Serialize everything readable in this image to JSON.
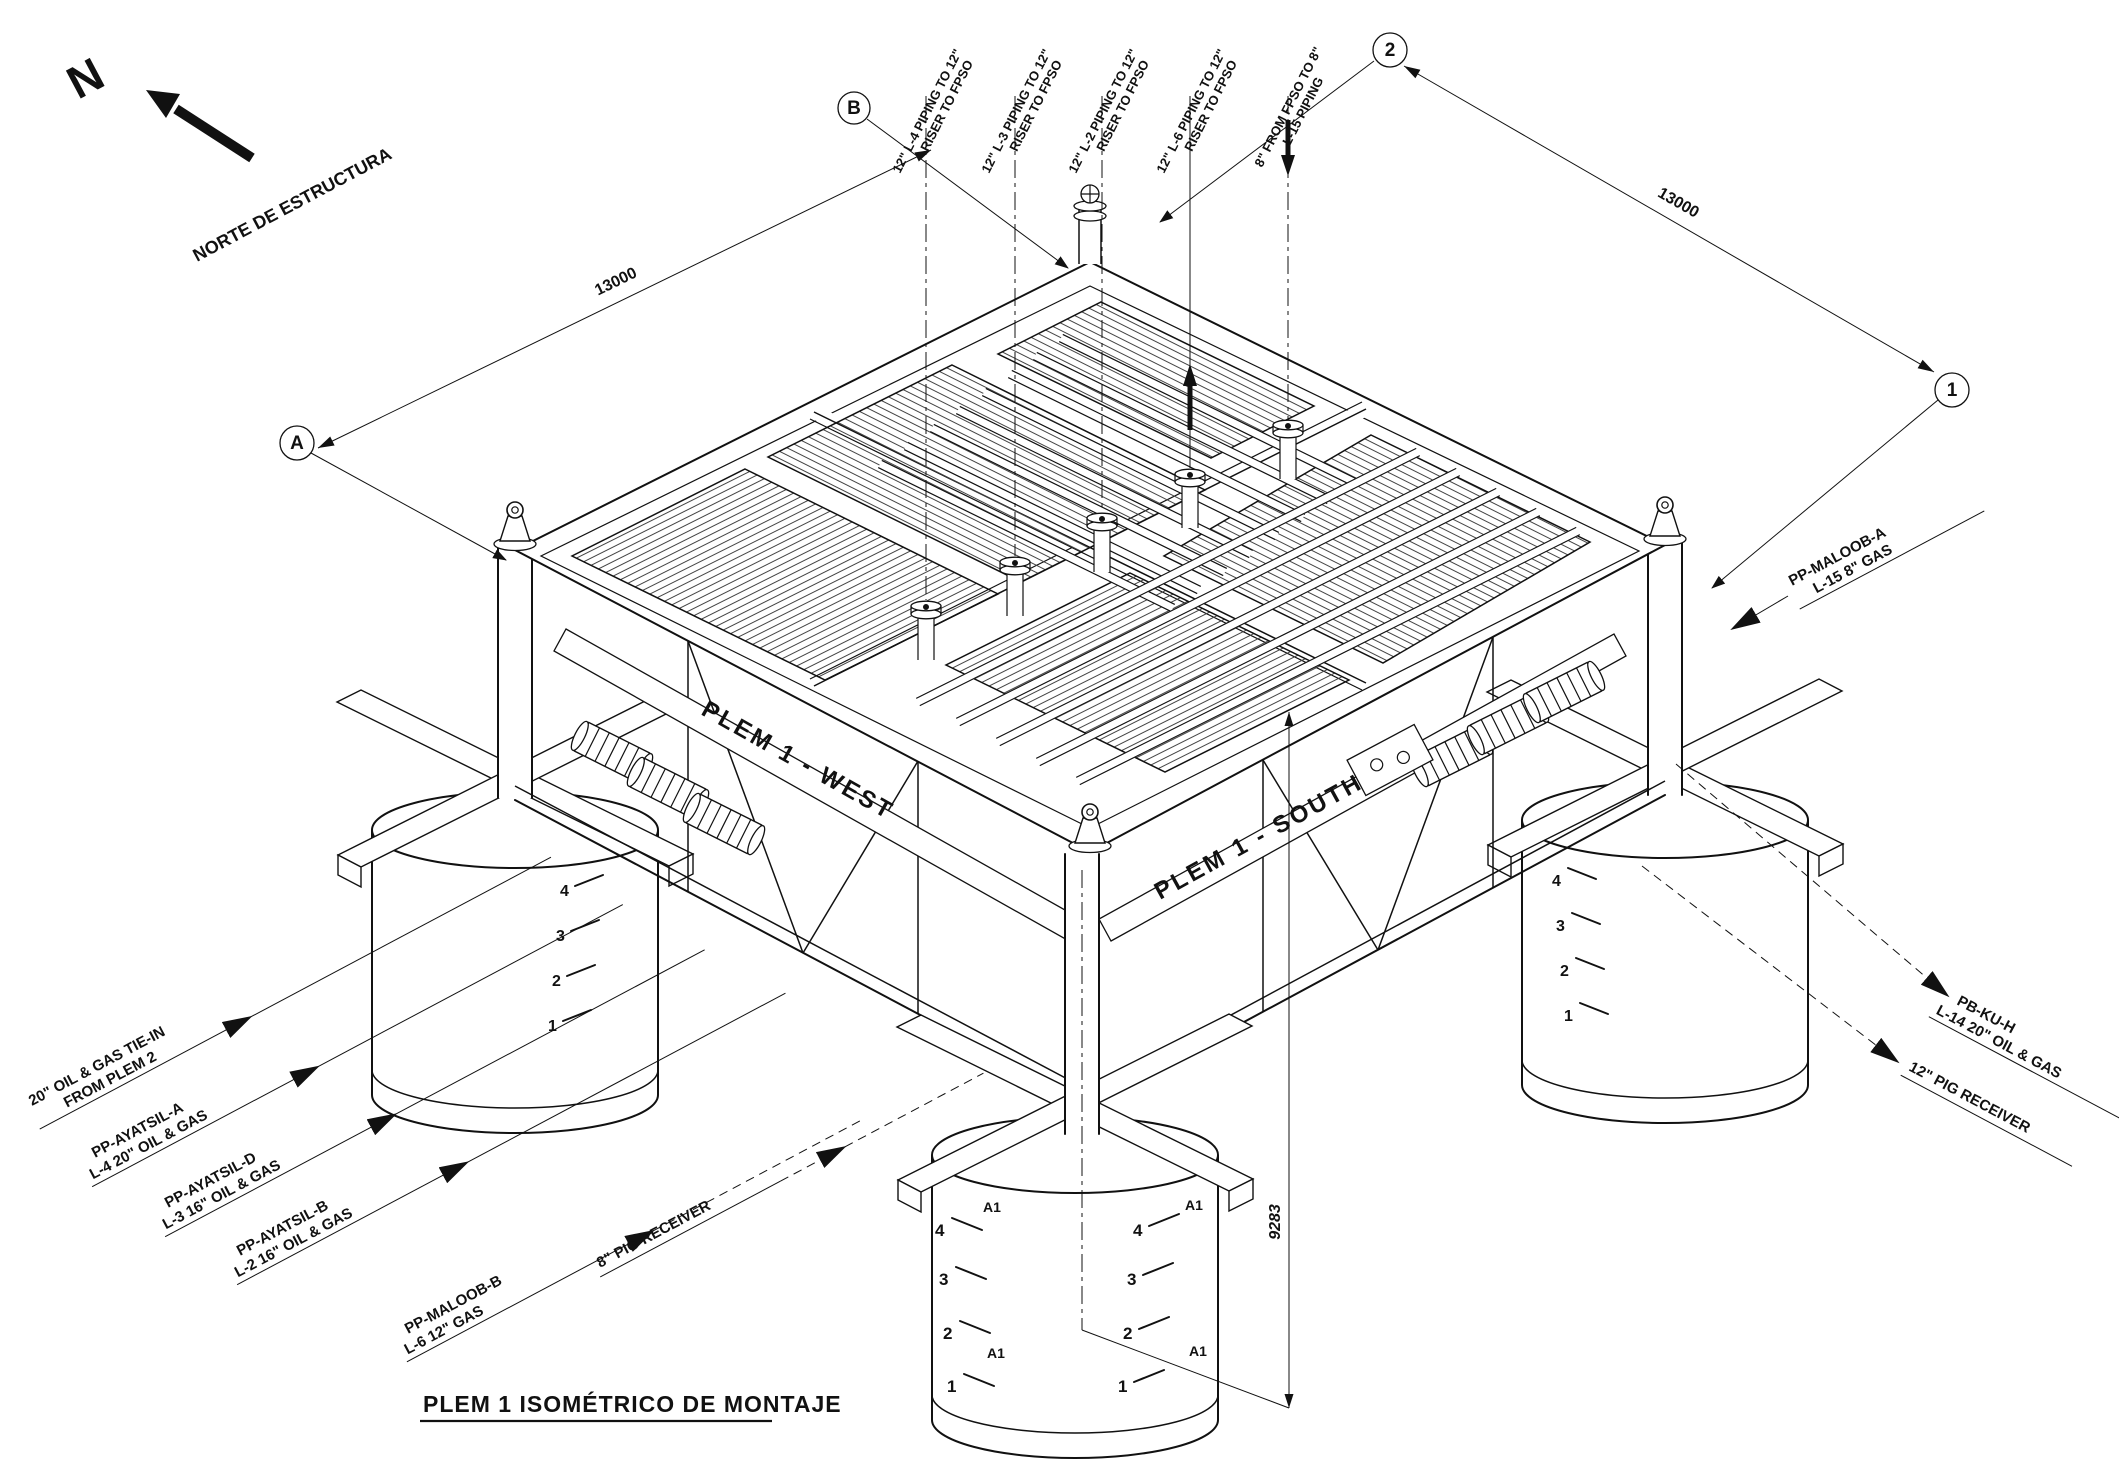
{
  "title": {
    "text": "PLEM 1 ISOMÉTRICO DE MONTAJE"
  },
  "north": {
    "letter": "N",
    "label": "NORTE DE ESTRUCTURA"
  },
  "grid": {
    "bubble_a": "A",
    "bubble_b": "B",
    "bubble_1": "1",
    "bubble_2": "2"
  },
  "dimensions": {
    "width_left": "13000",
    "width_right": "13000",
    "height": "9283"
  },
  "beam_markings": {
    "west": "PLEM 1 - WEST",
    "south": "PLEM 1 - SOUTH"
  },
  "pile_markings": {
    "levels": [
      "4",
      "3",
      "2",
      "1"
    ],
    "tag": "A1"
  },
  "riser_labels": [
    {
      "line1": "12\" L-4 PIPING TO 12\"",
      "line2": "RISER TO FPSO"
    },
    {
      "line1": "12\" L-3 PIPING TO 12\"",
      "line2": "RISER TO FPSO"
    },
    {
      "line1": "12\" L-2 PIPING TO 12\"",
      "line2": "RISER TO FPSO"
    },
    {
      "line1": "12\" L-6 PIPING TO 12\"",
      "line2": "RISER TO FPSO"
    },
    {
      "line1": "8\" FROM FPSO TO 8\"",
      "line2": "L-15 PIPING"
    }
  ],
  "left_labels": [
    {
      "line1": "20\" OIL & GAS TIE-IN",
      "line2": "FROM PLEM 2"
    },
    {
      "line1": "PP-AYATSIL-A",
      "line2": "L-4 20\" OIL & GAS"
    },
    {
      "line1": "PP-AYATSIL-D",
      "line2": "L-3 16\" OIL & GAS"
    },
    {
      "line1": "PP-AYATSIL-B",
      "line2": "L-2 16\" OIL & GAS"
    },
    {
      "line1": "PP-MALOOB-B",
      "line2": "L-6 12\" GAS"
    },
    {
      "line1": "8\" PIG RECEIVER",
      "line2": ""
    }
  ],
  "right_labels": [
    {
      "line1": "PP-MALOOB-A",
      "line2": "L-15 8\" GAS"
    },
    {
      "line1": "PB-KU-H",
      "line2": "L-14 20\" OIL & GAS"
    },
    {
      "line1": "12\" PIG RECEIVER",
      "line2": ""
    }
  ]
}
